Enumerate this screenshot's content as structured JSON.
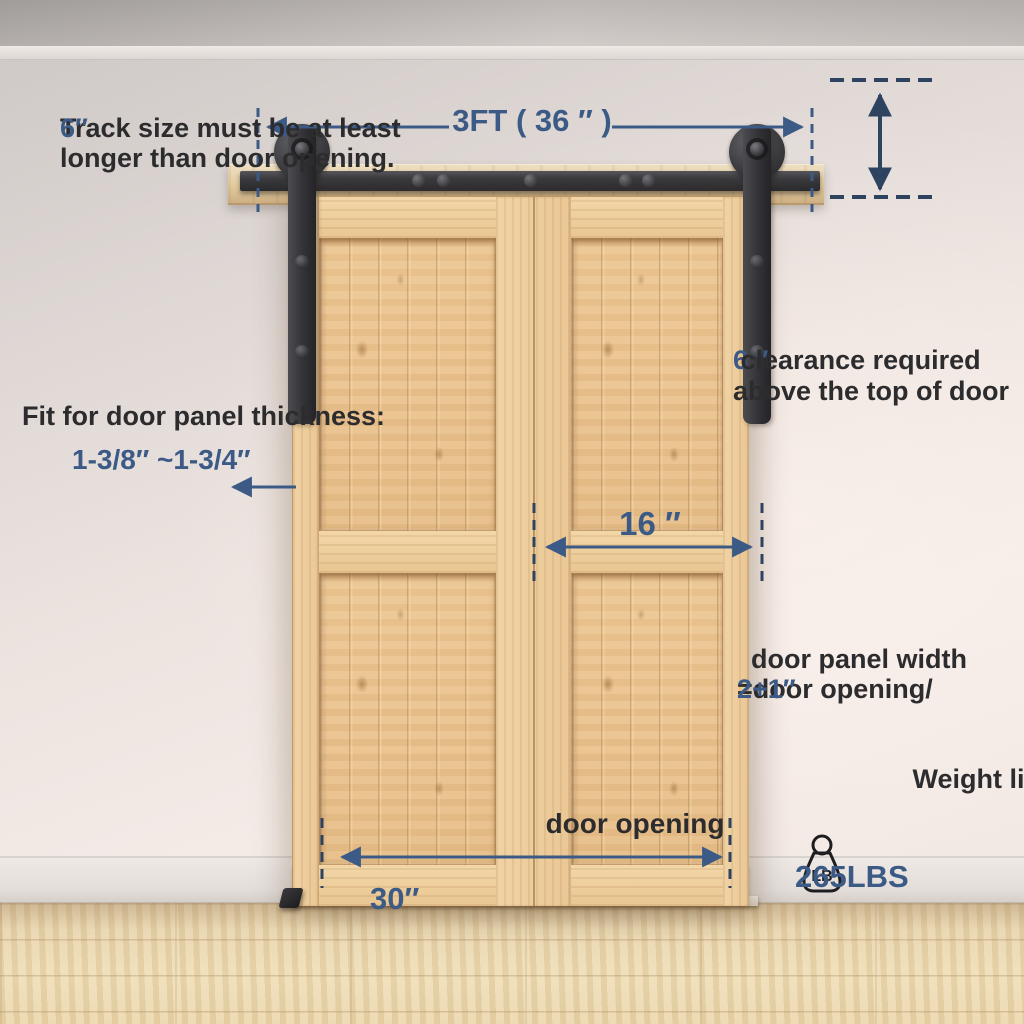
{
  "annotations": {
    "track_note": {
      "line1_text": "Track size must be at least ",
      "line1_highlight": "6″",
      "line2": "longer than door opening."
    },
    "track_length": {
      "label": "3FT ( 36 ″ )"
    },
    "clearance": {
      "highlight": "6 ″",
      "line1_text": " clearance required",
      "line2": "above the top of door"
    },
    "thickness": {
      "label": "Fit for door panel thickness:",
      "value": "1-3/8″ ~1-3/4″"
    },
    "panel_width": {
      "dim_label": "16 ″",
      "formula_line1": "door panel width",
      "formula_line2_text": "=door opening/",
      "formula_line2_highlight": "2+1″"
    },
    "door_opening": {
      "label": "door opening",
      "value": "30″"
    },
    "weight": {
      "label": "Weight limited",
      "unit": "LB",
      "value": "265LBS"
    }
  },
  "colors": {
    "accent_blue": "#3C5A86",
    "arrow_dark_navy": "#2E4360",
    "text_dark": "#2C2C2E",
    "hardware_black": "#343437",
    "door_wood": "#ECC795",
    "mounting_board_wood": "#E2CA9E",
    "wall": "#E9E0DC",
    "baseboard": "#EAE4E0",
    "floor_wood": "#E9D4AC",
    "threshold_strip": "#F4F0E8"
  }
}
